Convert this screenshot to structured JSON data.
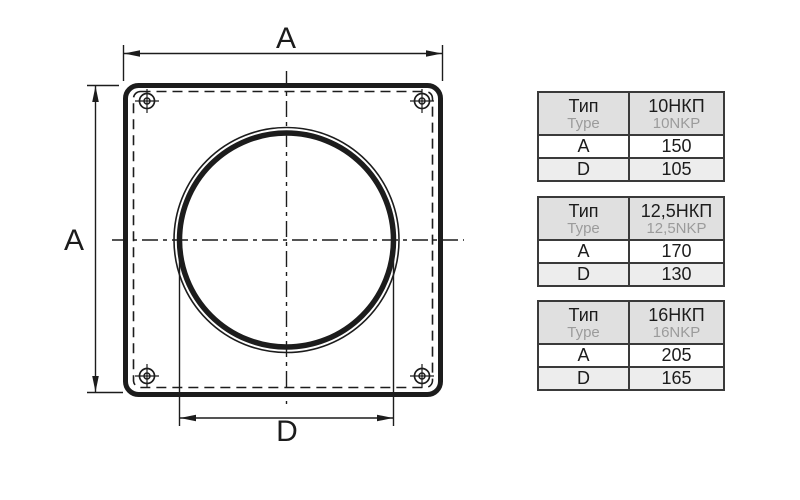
{
  "diagram": {
    "top_width_label": "A",
    "left_height_label": "A",
    "bottom_diameter_label": "D"
  },
  "tables": [
    {
      "header": {
        "param_ru": "Тип",
        "param_en": "Type",
        "type_ru": "10НКП",
        "type_en": "10NKP"
      },
      "rows": [
        {
          "param": "A",
          "value": "150"
        },
        {
          "param": "D",
          "value": "105"
        }
      ]
    },
    {
      "header": {
        "param_ru": "Тип",
        "param_en": "Type",
        "type_ru": "12,5НКП",
        "type_en": "12,5NKP"
      },
      "rows": [
        {
          "param": "A",
          "value": "170"
        },
        {
          "param": "D",
          "value": "130"
        }
      ]
    },
    {
      "header": {
        "param_ru": "Тип",
        "param_en": "Type",
        "type_ru": "16НКП",
        "type_en": "16NKP"
      },
      "rows": [
        {
          "param": "A",
          "value": "205"
        },
        {
          "param": "D",
          "value": "165"
        }
      ]
    }
  ],
  "colors": {
    "ink": "#1c1c1c",
    "table_border": "#3a3a3a",
    "table_header_bg": "#e0e0e0",
    "table_alt_row_bg": "#ededed",
    "secondary_text": "#9b9b9b"
  }
}
